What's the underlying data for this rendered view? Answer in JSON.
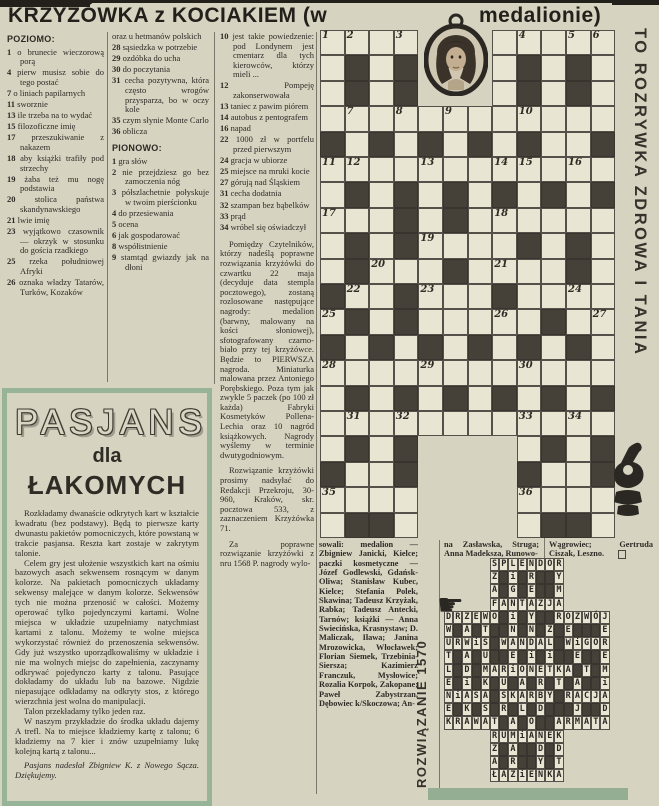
{
  "header": {
    "title_left": "KRZYŻÓWKA z KOCIAKIEM (w",
    "title_right": "medalionie)"
  },
  "side_banner": "TO ROZRYWKA ZDROWA I TANIA",
  "clues": {
    "across_label": "POZIOMO:",
    "down_label": "PIONOWO:",
    "across_col1": [
      {
        "n": "1",
        "t": "o brunecie wieczorową porą"
      },
      {
        "n": "4",
        "t": "pierw musisz sobie do tego postać"
      },
      {
        "n": "7",
        "t": "o liniach papilarnych"
      },
      {
        "n": "11",
        "t": "sworznie"
      },
      {
        "n": "13",
        "t": "ile trzeba na to wydać"
      },
      {
        "n": "15",
        "t": "filozoficzne imię"
      },
      {
        "n": "17",
        "t": "przeszukiwanie z nakazem"
      },
      {
        "n": "18",
        "t": "aby książki trafiły pod strzechy"
      },
      {
        "n": "19",
        "t": "żaba też mu nogę podstawia"
      },
      {
        "n": "20",
        "t": "stolica państwa skandynawskiego"
      },
      {
        "n": "21",
        "t": "lwie imię"
      },
      {
        "n": "23",
        "t": "wyjątkowo czasownik — okrzyk w stosunku do gościa rzadkiego"
      },
      {
        "n": "25",
        "t": "rzeka południowej Afryki"
      },
      {
        "n": "26",
        "t": "oznaka władzy Tatarów, Turków, Kozaków"
      }
    ],
    "across_col2": [
      {
        "n": "",
        "t": "oraz u hetmanów polskich"
      },
      {
        "n": "28",
        "t": "sąsiedzka w potrzebie"
      },
      {
        "n": "29",
        "t": "ozdóbka do ucha"
      },
      {
        "n": "30",
        "t": "do poczytania"
      },
      {
        "n": "31",
        "t": "cecha pozytywna, która często wrogów przysparza, bo w oczy kole"
      },
      {
        "n": "35",
        "t": "czym słynie Monte Carlo"
      },
      {
        "n": "36",
        "t": "oblicza"
      }
    ],
    "down_col2": [
      {
        "n": "1",
        "t": "gra słów"
      },
      {
        "n": "2",
        "t": "nie przejdziesz go bez zamoczenia nóg"
      },
      {
        "n": "3",
        "t": "półszlachetnie połyskuje w twoim pierścionku"
      },
      {
        "n": "4",
        "t": "do przesiewania"
      },
      {
        "n": "5",
        "t": "ocena"
      },
      {
        "n": "6",
        "t": "jak gospodarować"
      },
      {
        "n": "8",
        "t": "współistnienie"
      },
      {
        "n": "9",
        "t": "stamtąd gwiazdy jak na dłoni"
      }
    ],
    "down_col3": [
      {
        "n": "10",
        "t": "jest takie powiedzenie: pod Londynem jest cmentarz dla tych kierowców, którzy mieli ..."
      },
      {
        "n": "12",
        "t": "Pompeję zakonserwowała"
      },
      {
        "n": "13",
        "t": "taniec z pawim piórem"
      },
      {
        "n": "14",
        "t": "autobus z pentografem"
      },
      {
        "n": "16",
        "t": "napad"
      },
      {
        "n": "22",
        "t": "1000 zł w portfelu przed pierwszym"
      },
      {
        "n": "24",
        "t": "gracja w ubiorze"
      },
      {
        "n": "25",
        "t": "miejsce na mruki kocie"
      },
      {
        "n": "27",
        "t": "górują nad Śląskiem"
      },
      {
        "n": "31",
        "t": "cecha dodatnia"
      },
      {
        "n": "32",
        "t": "szampan bez bąbelków"
      },
      {
        "n": "33",
        "t": "prąd"
      },
      {
        "n": "34",
        "t": "wróbel się oświadczył"
      }
    ]
  },
  "prizes": {
    "p1": "Pomiędzy Czytelników, którzy nadeślą poprawne rozwiązania krzyżówki do czwartku 22 maja (decyduje data stempla pocztowego), zostaną rozlosowane następujące nagrody: medalion (barwny, malowany na kości słoniowej), sfotografowany czarno-biało przy tej krzyżówce. Będzie to PIERWSZA nagroda. Miniaturka malowana przez Antoniego Porębskiego. Poza tym jak zwykle 5 paczek (po 100 zł każda) Fabryki Kosmetyków Pollena-Lechia oraz 10 nagród książkowych. Nagrody wyślemy w terminie dwutygodniowym.",
    "p2": "Rozwiązanie krzyżówki prosimy nadsyłać do Redakcji Przekroju, 30-960, Kraków, skr. pocztowa 533, z zaznaczeniem Krzyżówka 71.",
    "p3": "Za poprawne rozwiązanie krzyżówki z nru 1568 P. nagrody wylo-"
  },
  "winners": {
    "col1": "sowali: medalion — Zbigniew Janicki, Kielce; paczki kosmetyczne — Józef Godlewski, Gdańsk-Oliwa; Stanisław Kubec, Kielce; Stefania Polek, Skawina; Tadeusz Krzyżak, Rabka; Tadeusz Antecki, Tarnów; książki — Anna Swiecińska, Krasnystaw; D. Maliczak, Iława; Janina Mrozowicka, Włocławek; Florian Siemek, Trzebinia-Siersza; Kazimierz Franczuk, Mysłowice; Rozalia Korpok, Zakopane; Paweł Zabystrzan, Dębowiec k/Skoczowa; An-",
    "col2": "na Zasławska, Struga; Anna Madeksza, Runowo-",
    "col3": "Wągrowiec; Gertruda Ciszak, Leszno."
  },
  "crossword": {
    "cells": [
      "....   .....",
      ".#.#   .#.#.",
      ".#.#   .#.#.",
      "............",
      "#.#.#.#.#..#",
      "............",
      ".#.#.#.#.#.#",
      "...#.#......",
      ".#.#....#.#.",
      ".#...#....#.",
      "#..#...#....",
      ".#.#.....#..",
      "#.#.#.#.#.#.",
      "............",
      ".#.#.#.#.#.#",
      "............",
      ".#.#    .#.#",
      "#..#    #..#",
      "....    ....",
      ".##.    .##."
    ],
    "numbers": [
      [
        1,
        1,
        1
      ],
      [
        1,
        2,
        2
      ],
      [
        1,
        4,
        3
      ],
      [
        1,
        9,
        4
      ],
      [
        1,
        11,
        5
      ],
      [
        1,
        12,
        6
      ],
      [
        4,
        2,
        7
      ],
      [
        4,
        4,
        8
      ],
      [
        4,
        6,
        9
      ],
      [
        4,
        9,
        10
      ],
      [
        6,
        1,
        11
      ],
      [
        6,
        2,
        12
      ],
      [
        6,
        5,
        13
      ],
      [
        6,
        8,
        14
      ],
      [
        6,
        9,
        15
      ],
      [
        6,
        11,
        16
      ],
      [
        8,
        1,
        17
      ],
      [
        8,
        8,
        18
      ],
      [
        9,
        5,
        19
      ],
      [
        10,
        3,
        20
      ],
      [
        10,
        8,
        21
      ],
      [
        11,
        2,
        22
      ],
      [
        11,
        5,
        23
      ],
      [
        11,
        11,
        24
      ],
      [
        12,
        1,
        25
      ],
      [
        12,
        8,
        26
      ],
      [
        12,
        12,
        27
      ],
      [
        14,
        1,
        28
      ],
      [
        14,
        5,
        29
      ],
      [
        14,
        9,
        30
      ],
      [
        16,
        2,
        31
      ],
      [
        16,
        4,
        32
      ],
      [
        16,
        9,
        33
      ],
      [
        16,
        11,
        34
      ],
      [
        19,
        1,
        35
      ],
      [
        19,
        9,
        36
      ]
    ]
  },
  "solution": {
    "label": "ROZWIĄZANIE 1570",
    "cells": [
      "     SPLENDOR     ",
      "     Z#i#R##Y     ",
      "     A#G#E##M     ",
      "     FANTAZJA     ",
      "DRZEWO#i#Y##ROZWÓJ",
      "W#A#T##N#N#Z#E###E",
      "URWiS#WANDAL#WiGOR",
      "T#A#U##E#i#i##E##E",
      "L#D#MARiONETKA#T#M",
      "E#i#K#U#A#R#T#A##i",
      "NiASA#SKARBY#RACJA",
      "E#K#S#R#L#D###J##D",
      "KRAWAT#A#O##ARMATA",
      "     RUMiANEK     ",
      "     Z#A##D#D     ",
      "     A#R##Y#T     ",
      "     ŁAZiENKA     "
    ]
  },
  "pasjans": {
    "title": "PASJANS",
    "subtitle1": "dla",
    "subtitle2": "ŁAKOMYCH",
    "paragraphs": [
      "Rozkładamy dwanaście odkrytych kart w kształcie kwadratu (bez podstawy). Będą to pierwsze karty dwunastu pakietów pomocniczych, które powstaną w trakcie pasjansa. Reszta kart zostaje w zakrytym talonie.",
      "Celem gry jest ułożenie wszystkich kart na ośmiu bazowych asach sekwensem rosnącym w danym kolorze. Na pakietach pomocniczych układamy sekwensy malejące w danym kolorze. Sekwensów tych nie można przenosić w całości. Możemy operować tylko pojedynczymi kartami. Wolne miejsca w układzie uzupełniamy natychmiast kartami z talonu. Możemy te wolne miejsca wykorzystać również do przenoszenia sekwensów. Gdy już wszystko uporządkowaliśmy w układzie i nie ma wolnych miejsc do zapełnienia, zaczynamy odkrywać pojedynczo karty z talonu. Pasujące dokładamy do układu lub na bazowe. Nigdzie niepasujące odkładamy na odkryty stos, z którego wierzchnia jest wolna do manipulacji.",
      "Talon przekładamy tylko jeden raz.",
      "W naszym przykładzie do środka układu dajemy A trefl. Na to miejsce kładziemy kartę z talonu; 6 kładziemy na 7 kier i znów uzupełniamy lukę kolejną kartą z talonu..."
    ],
    "credit": "Pasjans nadesłał Zbigniew K. z Nowego Sącza. Dziękujemy."
  },
  "colors": {
    "paper": "#d7d3c1",
    "ink": "#2d2a25",
    "grid_black": "#454038",
    "green": "#93ae93"
  }
}
